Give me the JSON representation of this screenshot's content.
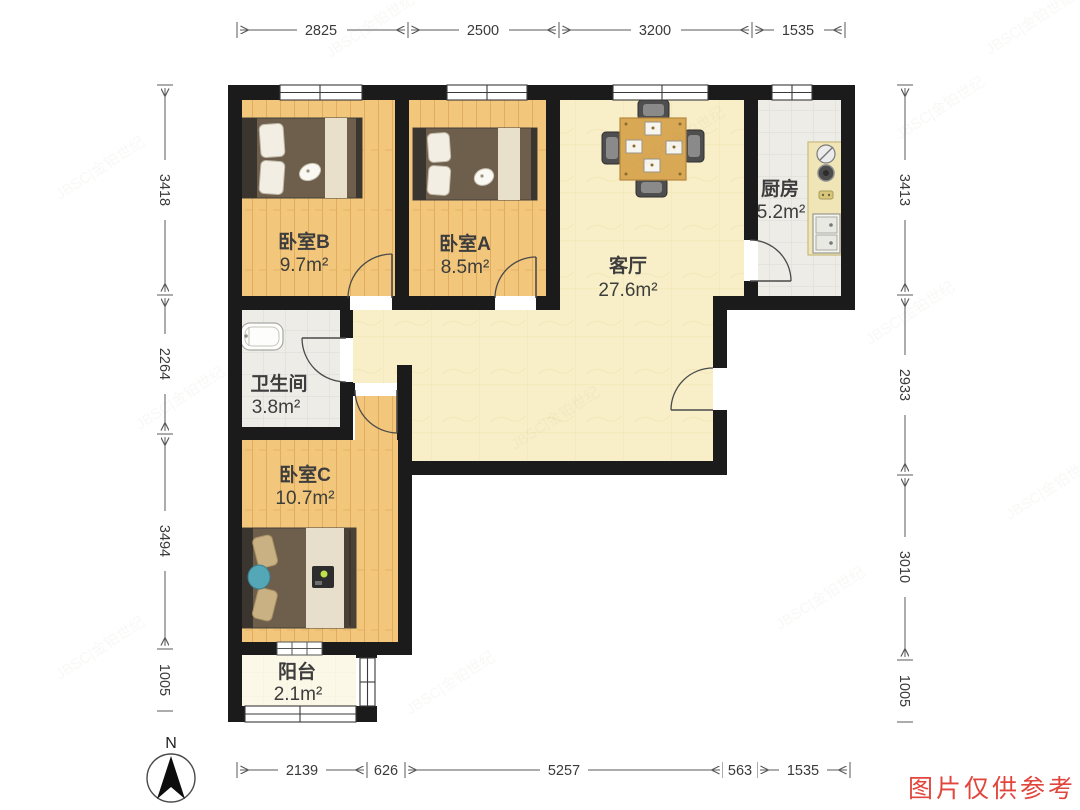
{
  "plan": {
    "rooms": [
      {
        "id": "bedroom-b",
        "label": "卧室B",
        "area": "9.7m²"
      },
      {
        "id": "bedroom-a",
        "label": "卧室A",
        "area": "8.5m²"
      },
      {
        "id": "living-room",
        "label": "客厅",
        "area": "27.6m²"
      },
      {
        "id": "kitchen",
        "label": "厨房",
        "area": "5.2m²"
      },
      {
        "id": "bathroom",
        "label": "卫生间",
        "area": "3.8m²"
      },
      {
        "id": "bedroom-c",
        "label": "卧室C",
        "area": "10.7m²"
      },
      {
        "id": "balcony",
        "label": "阳台",
        "area": "2.1m²"
      }
    ],
    "dimensions": {
      "top": [
        "2825",
        "2500",
        "3200",
        "1535"
      ],
      "left": [
        "3418",
        "2264",
        "3494",
        "1005"
      ],
      "right": [
        "3413",
        "2933",
        "3010",
        "1005"
      ],
      "bottom": [
        "2139",
        "626",
        "5257",
        "563",
        "1535"
      ]
    },
    "compass": {
      "label": "N"
    },
    "colors": {
      "wall": "#1b1b1b",
      "wood_floor": "#f2c67b",
      "living_floor": "#f8efc8",
      "tile_floor": "#edece7",
      "balcony_floor": "#fbf8e7",
      "notice_red": "#e2453c"
    }
  },
  "watermark": {
    "text": "JBSC|金铂世纪",
    "notice": "图片仅供参考"
  }
}
